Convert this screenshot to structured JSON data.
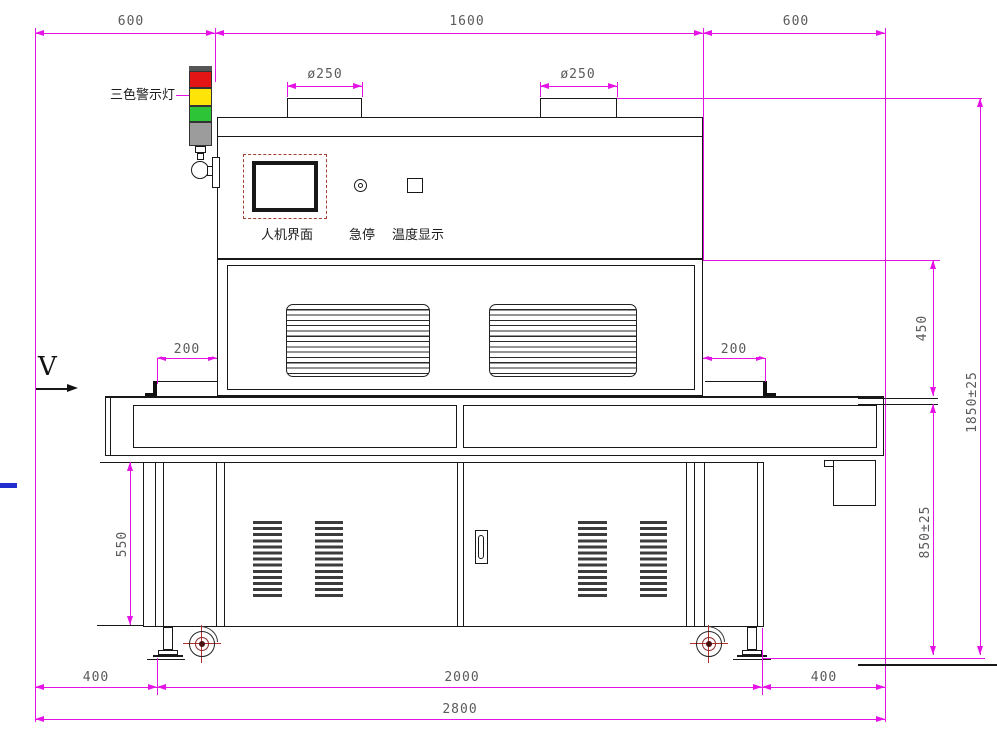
{
  "drawing": {
    "type": "machine-front-view-engineering-drawing",
    "labels": {
      "warning_light": "三色警示灯",
      "hmi_screen": "人机界面",
      "emergency_stop": "急停",
      "temperature_display": "温度显示",
      "belt_direction": "V"
    },
    "dimensions": {
      "top_left_width": "600",
      "top_center_width": "1600",
      "top_right_width": "600",
      "left_vent_diameter": "ø250",
      "right_vent_diameter": "ø250",
      "left_belt_overhang": "200",
      "right_belt_overhang": "200",
      "cabinet_height": "550",
      "tunnel_height": "450",
      "belt_height": "850±25",
      "total_height": "1850±25",
      "bottom_left_offset": "400",
      "wheelbase": "2000",
      "bottom_right_offset": "400",
      "total_width": "2800"
    },
    "colors": {
      "dimension_line": "#e512e5",
      "dimension_text": "#5a5a5a",
      "outline": "#181818",
      "warning_red": "#e31515",
      "warning_yellow": "#ffe408",
      "warning_green": "#2ec437",
      "warning_gray": "#9c9c9c",
      "hmi_frame_accent": "#a04030",
      "left_edge_mark": "#1f2ecc"
    }
  }
}
